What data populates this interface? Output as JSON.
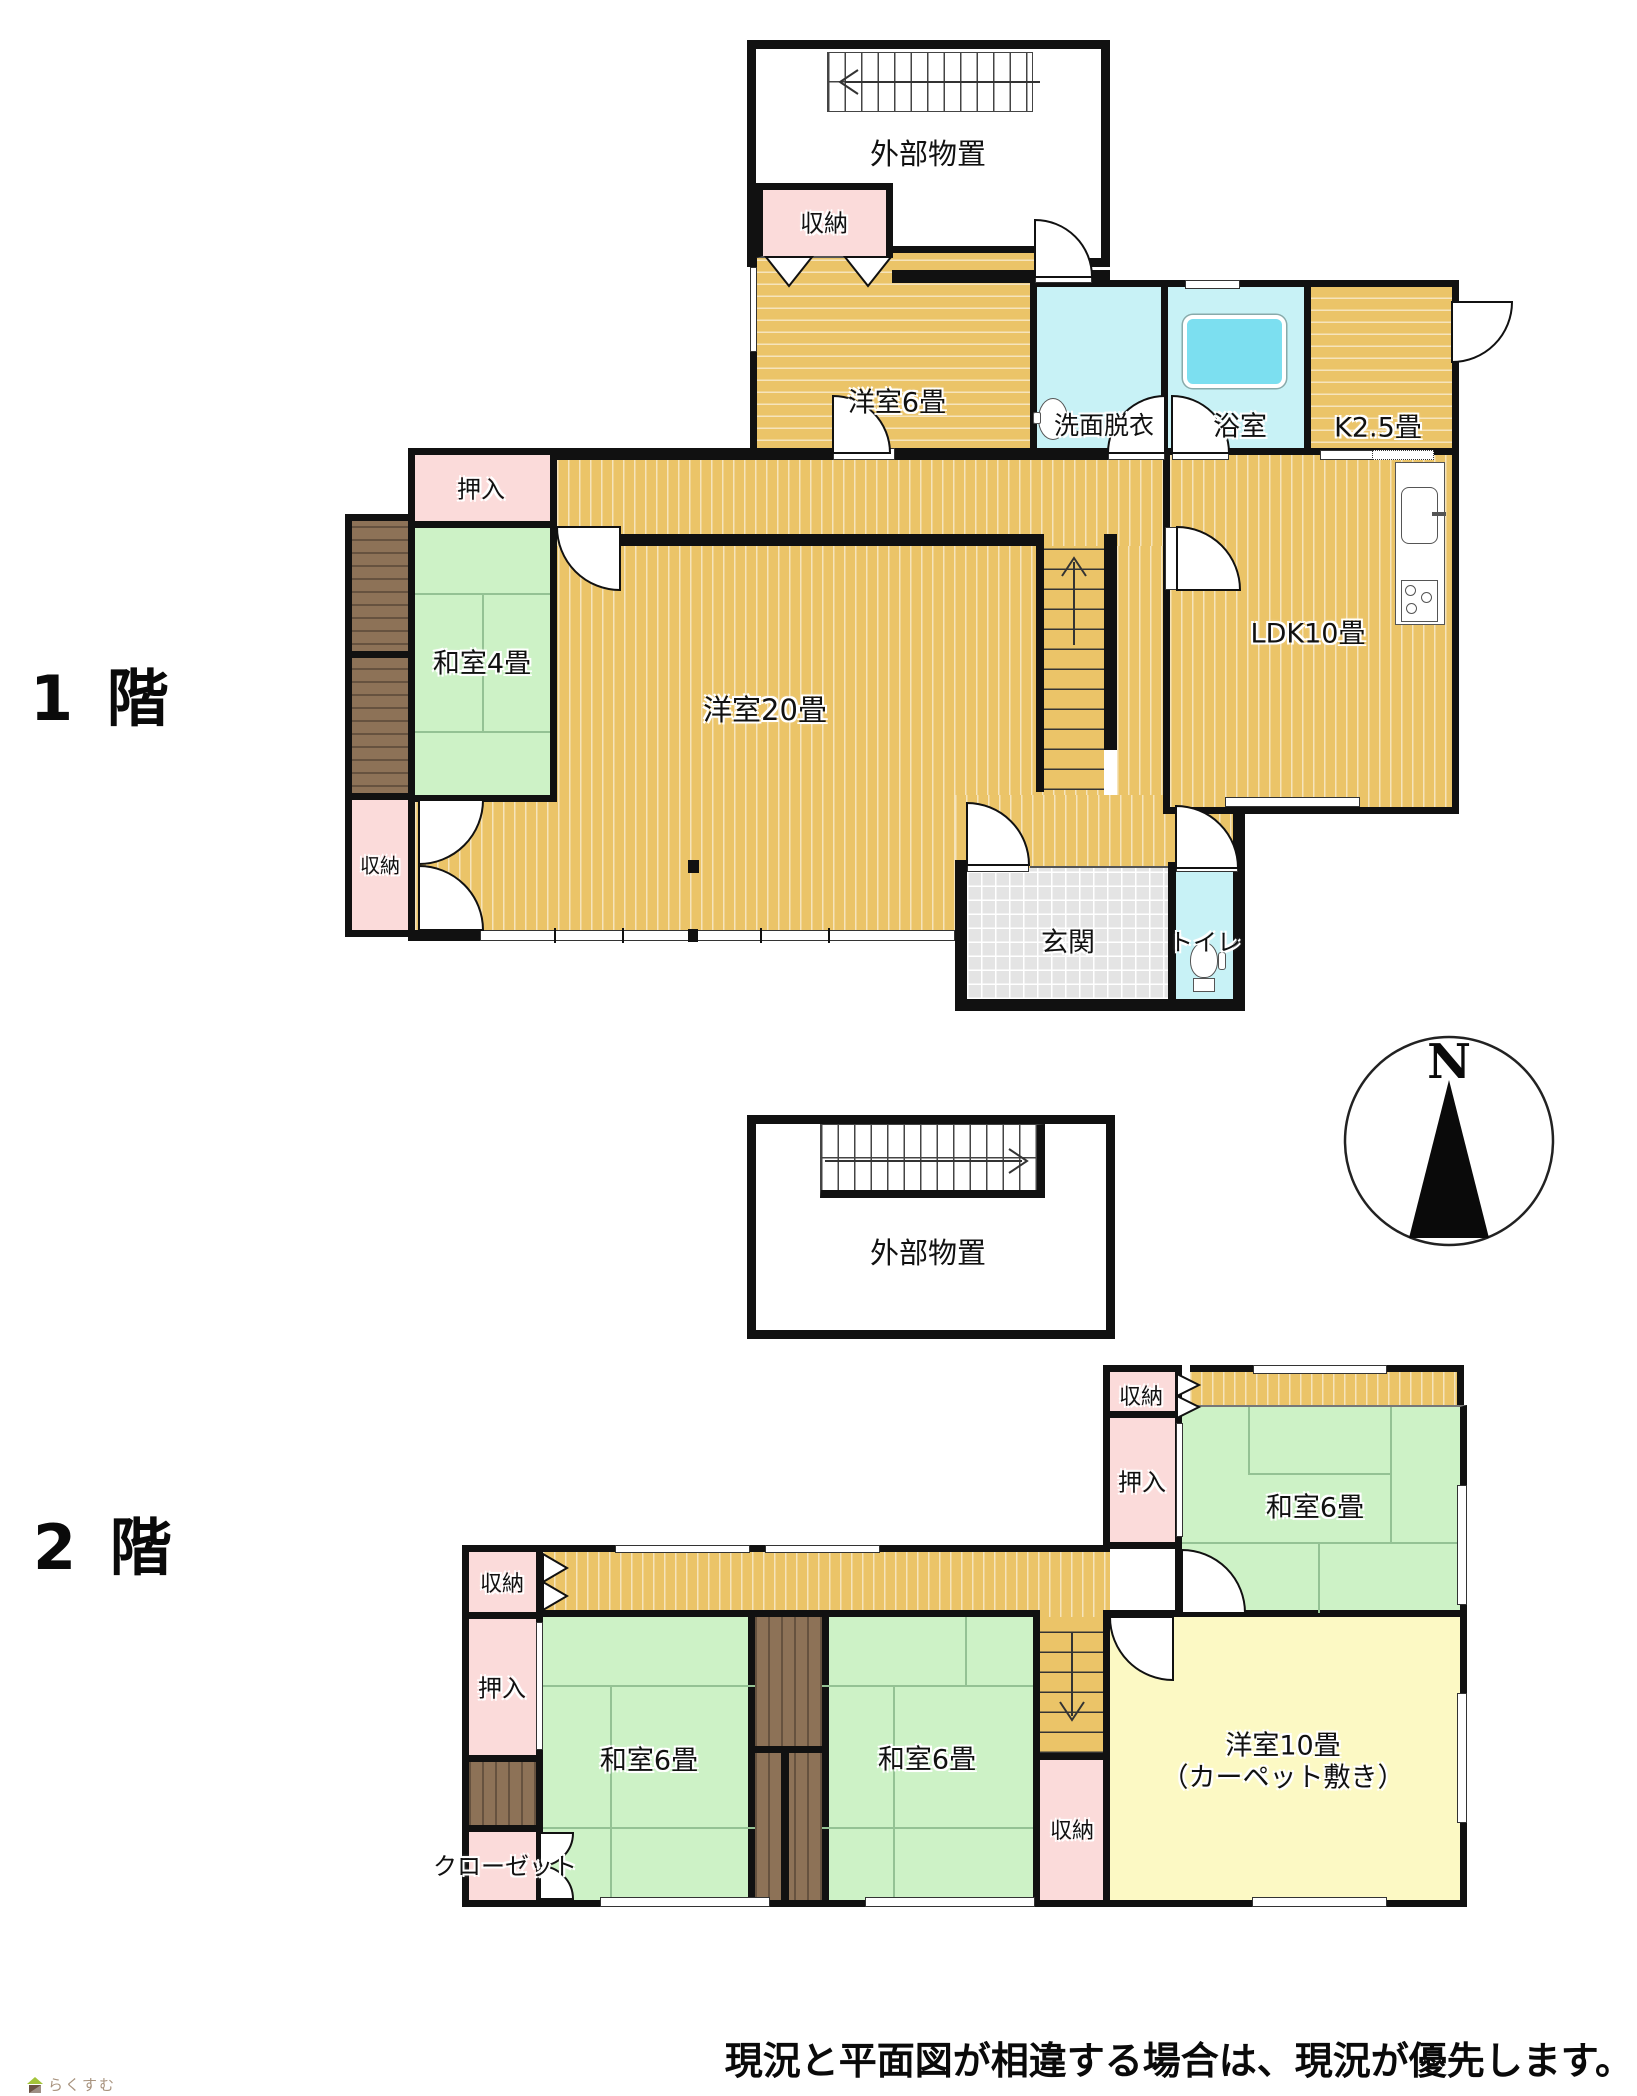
{
  "floor1": {
    "title": "1 階"
  },
  "floor2": {
    "title": "2 階"
  },
  "compass": {
    "n": "N"
  },
  "footer": {
    "disclaimer": "現況と平面図が相違する場合は、現況が優先します。",
    "logo_text": "らくすむ"
  },
  "labels": {
    "f1_ext_storage": "外部物置",
    "f1_shuno_top": "収納",
    "f1_yoshitsu6": "洋室6畳",
    "f1_senmen": "洗面脱衣",
    "f1_bath": "浴室",
    "f1_kitchen": "K2.5畳",
    "f1_oshiire": "押入",
    "f1_washitsu4": "和室4畳",
    "f1_shuno_left": "収納",
    "f1_yoshitsu20": "洋室20畳",
    "f1_ldk": "LDK10畳",
    "f1_genkan": "玄関",
    "f1_toilet": "トイレ",
    "f2_ext_storage": "外部物置",
    "f2_shuno_right": "収納",
    "f2_oshiire_right": "押入",
    "f2_washitsu6_right": "和室6畳",
    "f2_shuno_left": "収納",
    "f2_oshiire_left": "押入",
    "f2_washitsu6_left": "和室6畳",
    "f2_washitsu6_mid": "和室6畳",
    "f2_closet": "クローゼット",
    "f2_shuno_bottom": "収納",
    "f2_yoshitsu10_line1": "洋室10畳",
    "f2_yoshitsu10_line2": "（カーペット敷き）"
  },
  "colors": {
    "wall": "#111111",
    "wood_floor": "#ebc468",
    "tatami": "#cdf2c6",
    "closet_pink": "#fbdbda",
    "wet_area_cyan": "#c8f2f6",
    "bathtub": "#7cdff0",
    "carpet_yellow": "#fcf9c4",
    "veranda_brown": "#8d7257",
    "entrance_tile": "#e4e4e4"
  }
}
